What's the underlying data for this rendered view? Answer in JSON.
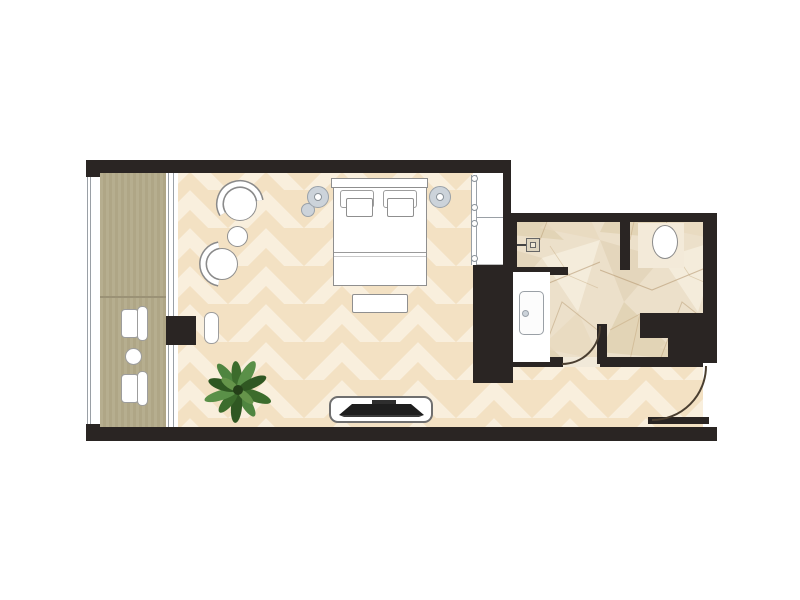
{
  "document": {
    "type": "hotel-room-floor-plan",
    "orientation": "top-down",
    "text_labels": []
  },
  "palette": {
    "wall": "#2a2523",
    "background": "#ffffff",
    "chevron_floor_base": "#f3e1c3",
    "chevron_floor_band": "#f9efdd",
    "deck_wood": "#b5ad8e",
    "deck_seam": "#9b9276",
    "marble_base": "#ece0ca",
    "marble_vein": "#b2946b",
    "furniture_fill": "#ffffff",
    "furniture_outline": "#8f8f8f",
    "lamp_fill": "#ccd3da",
    "door_arc": "#4a3e30",
    "tv_dark": "#222222",
    "plant_green_dark": "#2f5722",
    "plant_green_mid": "#3c6c2c",
    "plant_green_light": "#5a9048",
    "threshold": "#f1e9d9",
    "toilet_tile": "#f3ead9"
  },
  "rooms": [
    {
      "name": "balcony",
      "floor": "wood-deck",
      "items": [
        "balcony-chair",
        "balcony-chair",
        "balcony-side-table",
        "balcony-railing"
      ]
    },
    {
      "name": "bedroom",
      "floor": "chevron-parquet",
      "items": [
        "double-bed",
        "pillows",
        "headboard",
        "bedside-lamp-left",
        "bedside-lamp-right",
        "bedside-stool",
        "foot-bench",
        "armchair",
        "armchair",
        "round-side-table",
        "potted-plant",
        "tv-console",
        "wardrobe",
        "window-stool",
        "sliding-glass-door"
      ]
    },
    {
      "name": "bathroom",
      "floor": "marble-tile",
      "items": [
        "walk-in-shower",
        "shower-drain",
        "vanity-sink",
        "toilet",
        "toilet-partition-wall",
        "bathroom-door"
      ]
    },
    {
      "name": "entry-hall",
      "floor": "chevron-parquet",
      "items": [
        "entry-door"
      ]
    }
  ]
}
